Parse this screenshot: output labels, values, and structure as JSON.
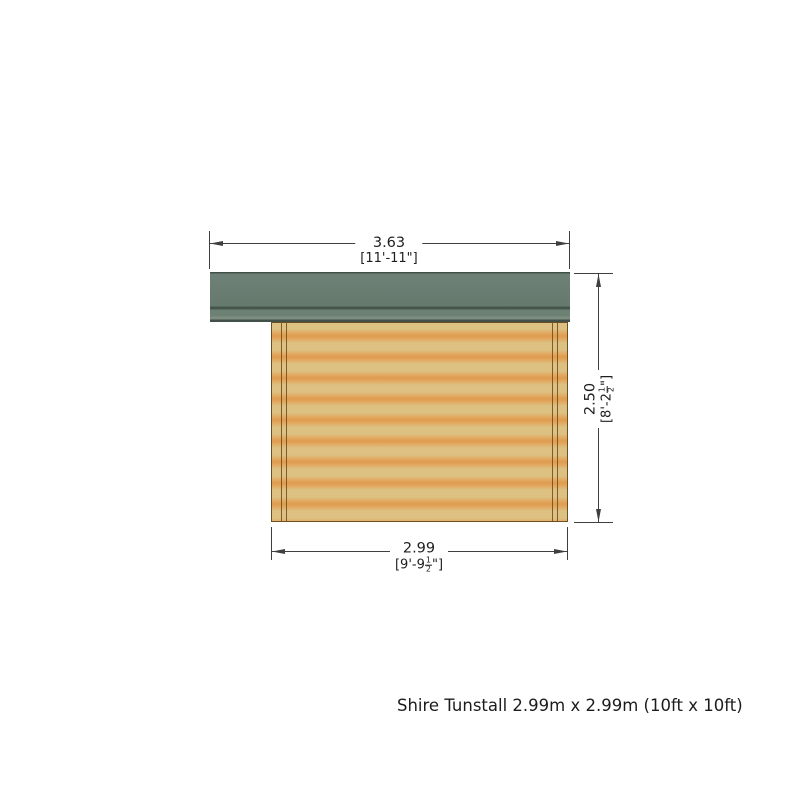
{
  "caption": "Shire Tunstall 2.99m x 2.99m (10ft x 10ft)",
  "dimensions": {
    "top": {
      "metric": "3.63",
      "imperial": "[11'-11\"]"
    },
    "right": {
      "metric": "2.50",
      "imperial_prefix": "[8'-2",
      "fraction_numerator": "1",
      "fraction_denominator": "2",
      "imperial_suffix": "\"]"
    },
    "bottom": {
      "metric": "2.99",
      "imperial_prefix": "[9'-9",
      "fraction_numerator": "1",
      "fraction_denominator": "2",
      "imperial_suffix": "\"]"
    }
  },
  "colors": {
    "roof_green": "#687c71",
    "roof_fascia": "#6d8074",
    "roof_outline": "#42504a",
    "wood_light": "#dcc183",
    "wood_orange": "#df9c4f",
    "post_line": "#6e4a1c",
    "dimension_line": "#3f3f3f",
    "text": "#1e1e1e"
  }
}
